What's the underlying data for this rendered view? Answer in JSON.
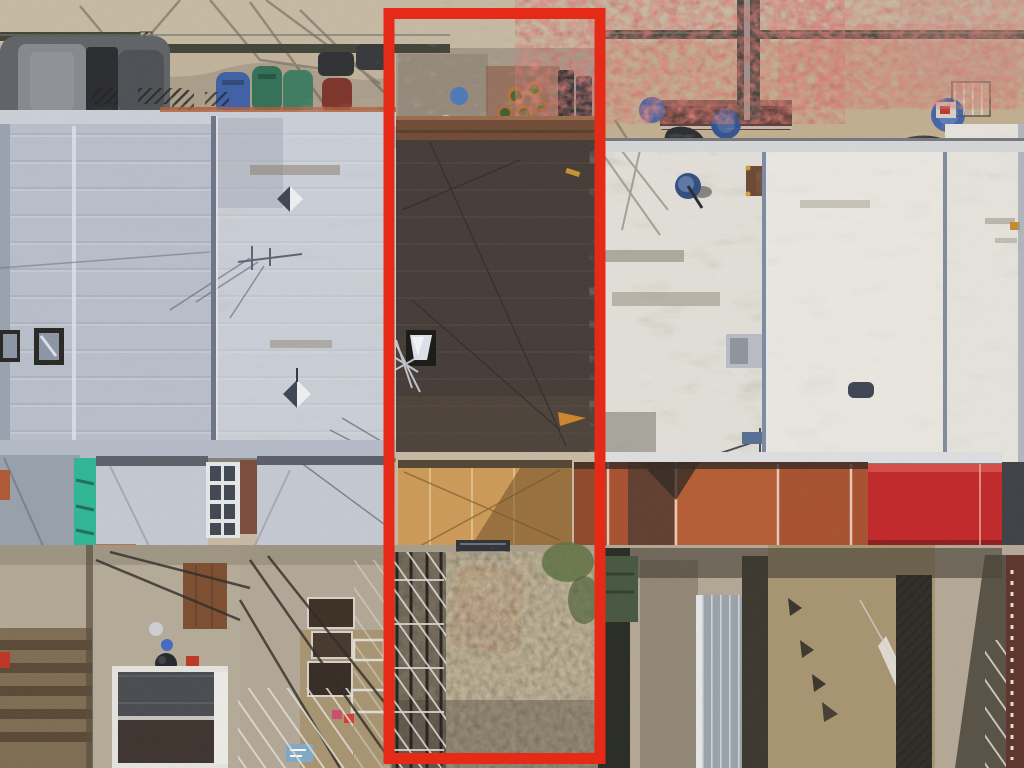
{
  "scene": {
    "type": "aerial-drone-photo",
    "subject": "row of attached rowhouses seen from directly above, with street at top, flat roofs in the middle, rear extensions and backyards below",
    "highlight": {
      "label": "highlighted-property-outline",
      "stroke_px": 11
    },
    "landmarks": [
      "street-sidewalk",
      "parked-car-street",
      "trash-bins",
      "iron-railings",
      "silver-metal-roofs",
      "white-mottled-roofs",
      "dark-roof-highlighted-house",
      "skylights",
      "pyramid-skylights",
      "satellite-dish",
      "roof-antennas",
      "teal-rear-strip",
      "tan-rear-roof",
      "rust-rear-roofs",
      "red-rear-roof",
      "backyards",
      "scaffolding-piles",
      "scaffold-tower",
      "garden-shed",
      "grill",
      "blue-barrels",
      "overgrown-yard",
      "backyard-orange-car",
      "red-spring-trees",
      "tree-branch-shadows",
      "planter-pots",
      "maroon-awning"
    ]
  },
  "colors": {
    "highlight": "#e52b17",
    "pavement": "#c8bba4",
    "front_yard_left": "#c2b29a",
    "front_yard_center": "#a59888",
    "front_yard_right": "#c3af90",
    "roof_silver": "#b9c0cd",
    "roof_mottled": "#ccd1da",
    "roof_dark": "#413833",
    "parapet_brown": "#6f4833",
    "roof_white_streaked": "#e5e2db",
    "roof_white": "#edeae4",
    "roof_white_right": "#e9e6e0",
    "ext_teal": "#2ab795",
    "ext_tan": "#cf9a55",
    "ext_rust": "#a84e2c",
    "ext_red": "#c32325",
    "ext_silver": "#c6cbd4",
    "yard_concrete": "#b4a996",
    "yard_dirt": "#a8946f",
    "shrub_base": "#6e6152",
    "car_street": "#5d6065",
    "car_backyard": "#c63a1e",
    "bin_blue": "#3b5ea6",
    "bin_green": "#2f6e55",
    "bin_maroon": "#7c2f26",
    "barrel_blue": "#3f62a8",
    "dish_blue": "#2f4a7d",
    "shed_wall": "#e8e6e0",
    "shed_roof": "#45484e",
    "awning_maroon": "#5e3a35",
    "foliage_red": "#8a3530",
    "shadow": "#4a463c"
  }
}
